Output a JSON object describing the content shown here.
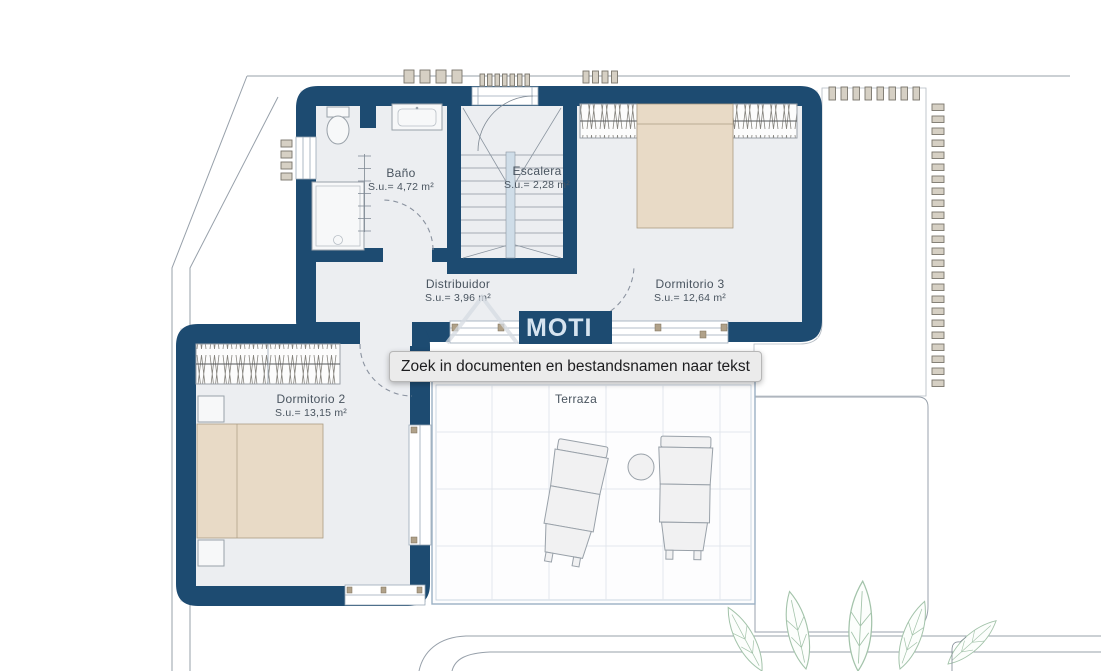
{
  "colors": {
    "wall": "#1d4b71",
    "floor": "#eceef1",
    "bed": "#e8dac6",
    "bed_stroke": "#ab9c83",
    "furniture_fill": "#f1f1f2",
    "furniture_stroke": "#99a1a9",
    "line": "#97a0aa",
    "grid": "#e2e7ed",
    "terrace_border": "#9bb0c4",
    "gravel_bg": "#f5f6f8",
    "gravel_dot": "#c5cbd4",
    "vent_fill": "#d6d0c4",
    "vent_stroke": "#79756c",
    "glass_frame": "#9aa8b6",
    "mullion": "#b0a189",
    "label": "#49545f",
    "leaf_stroke": "#a3c3aa",
    "door_arc": "#8b93a0",
    "watermark_bg": "#1d4b71",
    "watermark_text": "#d6e4f0",
    "watermark_faint": "#d6dbe2",
    "tooltip_bg": "#ebebeb",
    "tooltip_border": "#b7b7b7",
    "tooltip_text": "#1d1d1f"
  },
  "tooltip": {
    "text": "Zoek in documenten en bestandsnamen naar tekst"
  },
  "watermark": {
    "text": "MOTI"
  },
  "rooms": [
    {
      "id": "bano",
      "name": "Baño",
      "area": "S.u.= 4,72 m²"
    },
    {
      "id": "escalera",
      "name": "Escalera",
      "area": "S.u.= 2,28 m²"
    },
    {
      "id": "distribuidor",
      "name": "Distribuidor",
      "area": "S.u.= 3,96 m²"
    },
    {
      "id": "dormitorio3",
      "name": "Dormitorio 3",
      "area": "S.u.= 12,64 m²"
    },
    {
      "id": "dormitorio2",
      "name": "Dormitorio 2",
      "area": "S.u.= 13,15 m²"
    },
    {
      "id": "terraza",
      "name": "Terraza",
      "area": ""
    }
  ]
}
